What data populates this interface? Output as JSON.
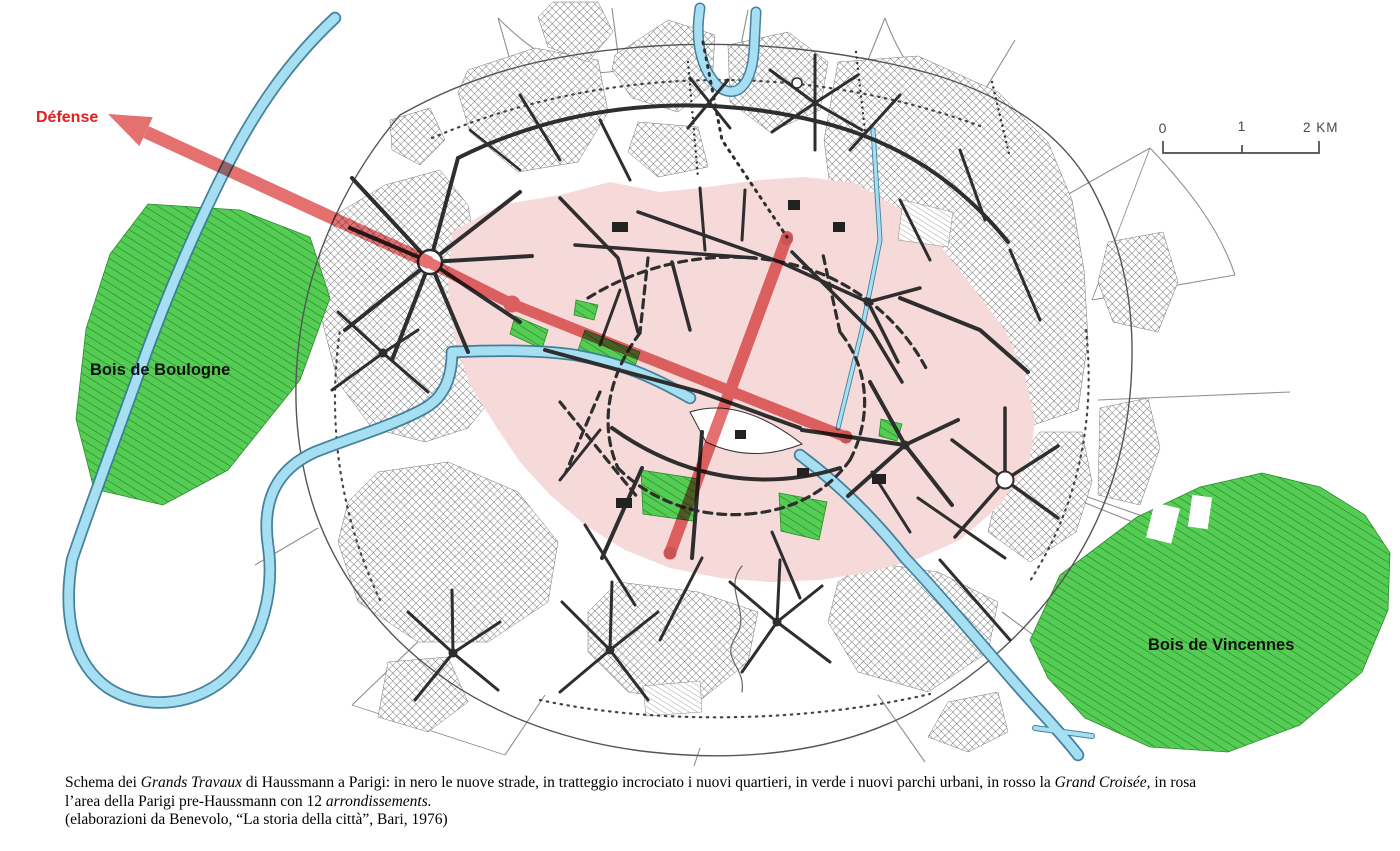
{
  "figure": {
    "labels": {
      "defense": "Défense",
      "bois_de_boulogne": "Bois de Boulogne",
      "bois_de_vincennes": "Bois de Vincennes"
    },
    "scale_bar": {
      "tick0": "0",
      "tick1": "1",
      "tick2": "2 KM"
    }
  },
  "colors": {
    "croisee-red": "#dd4848",
    "park-green": "#55cd55",
    "river-blue": "#a6dff2",
    "river-edge": "#3a7b99",
    "pink": "#f6d9d9",
    "label-red": "#e31e1e",
    "road-black": "#2e2e2e",
    "hatch-gray": "#4a4a4a"
  },
  "caption": {
    "line1": [
      {
        "text": "Schema dei ",
        "italic": false
      },
      {
        "text": "Grands Travaux",
        "italic": true
      },
      {
        "text": " di Haussmann a Parigi: in nero le nuove strade, in tratteggio incrociato i nuovi quartieri, in verde i nuovi parchi urbani, in rosso la ",
        "italic": false
      },
      {
        "text": "Grand Croisée",
        "italic": true
      },
      {
        "text": ", in rosa",
        "italic": false
      }
    ],
    "line2": [
      {
        "text": "l’area della Parigi pre-Haussmann con 12 ",
        "italic": false
      },
      {
        "text": "arrondissements.",
        "italic": true
      }
    ],
    "line3": [
      {
        "text": "(elaborazioni da Benevolo, “La storia della città”, Bari, 1976)",
        "italic": false
      }
    ]
  }
}
